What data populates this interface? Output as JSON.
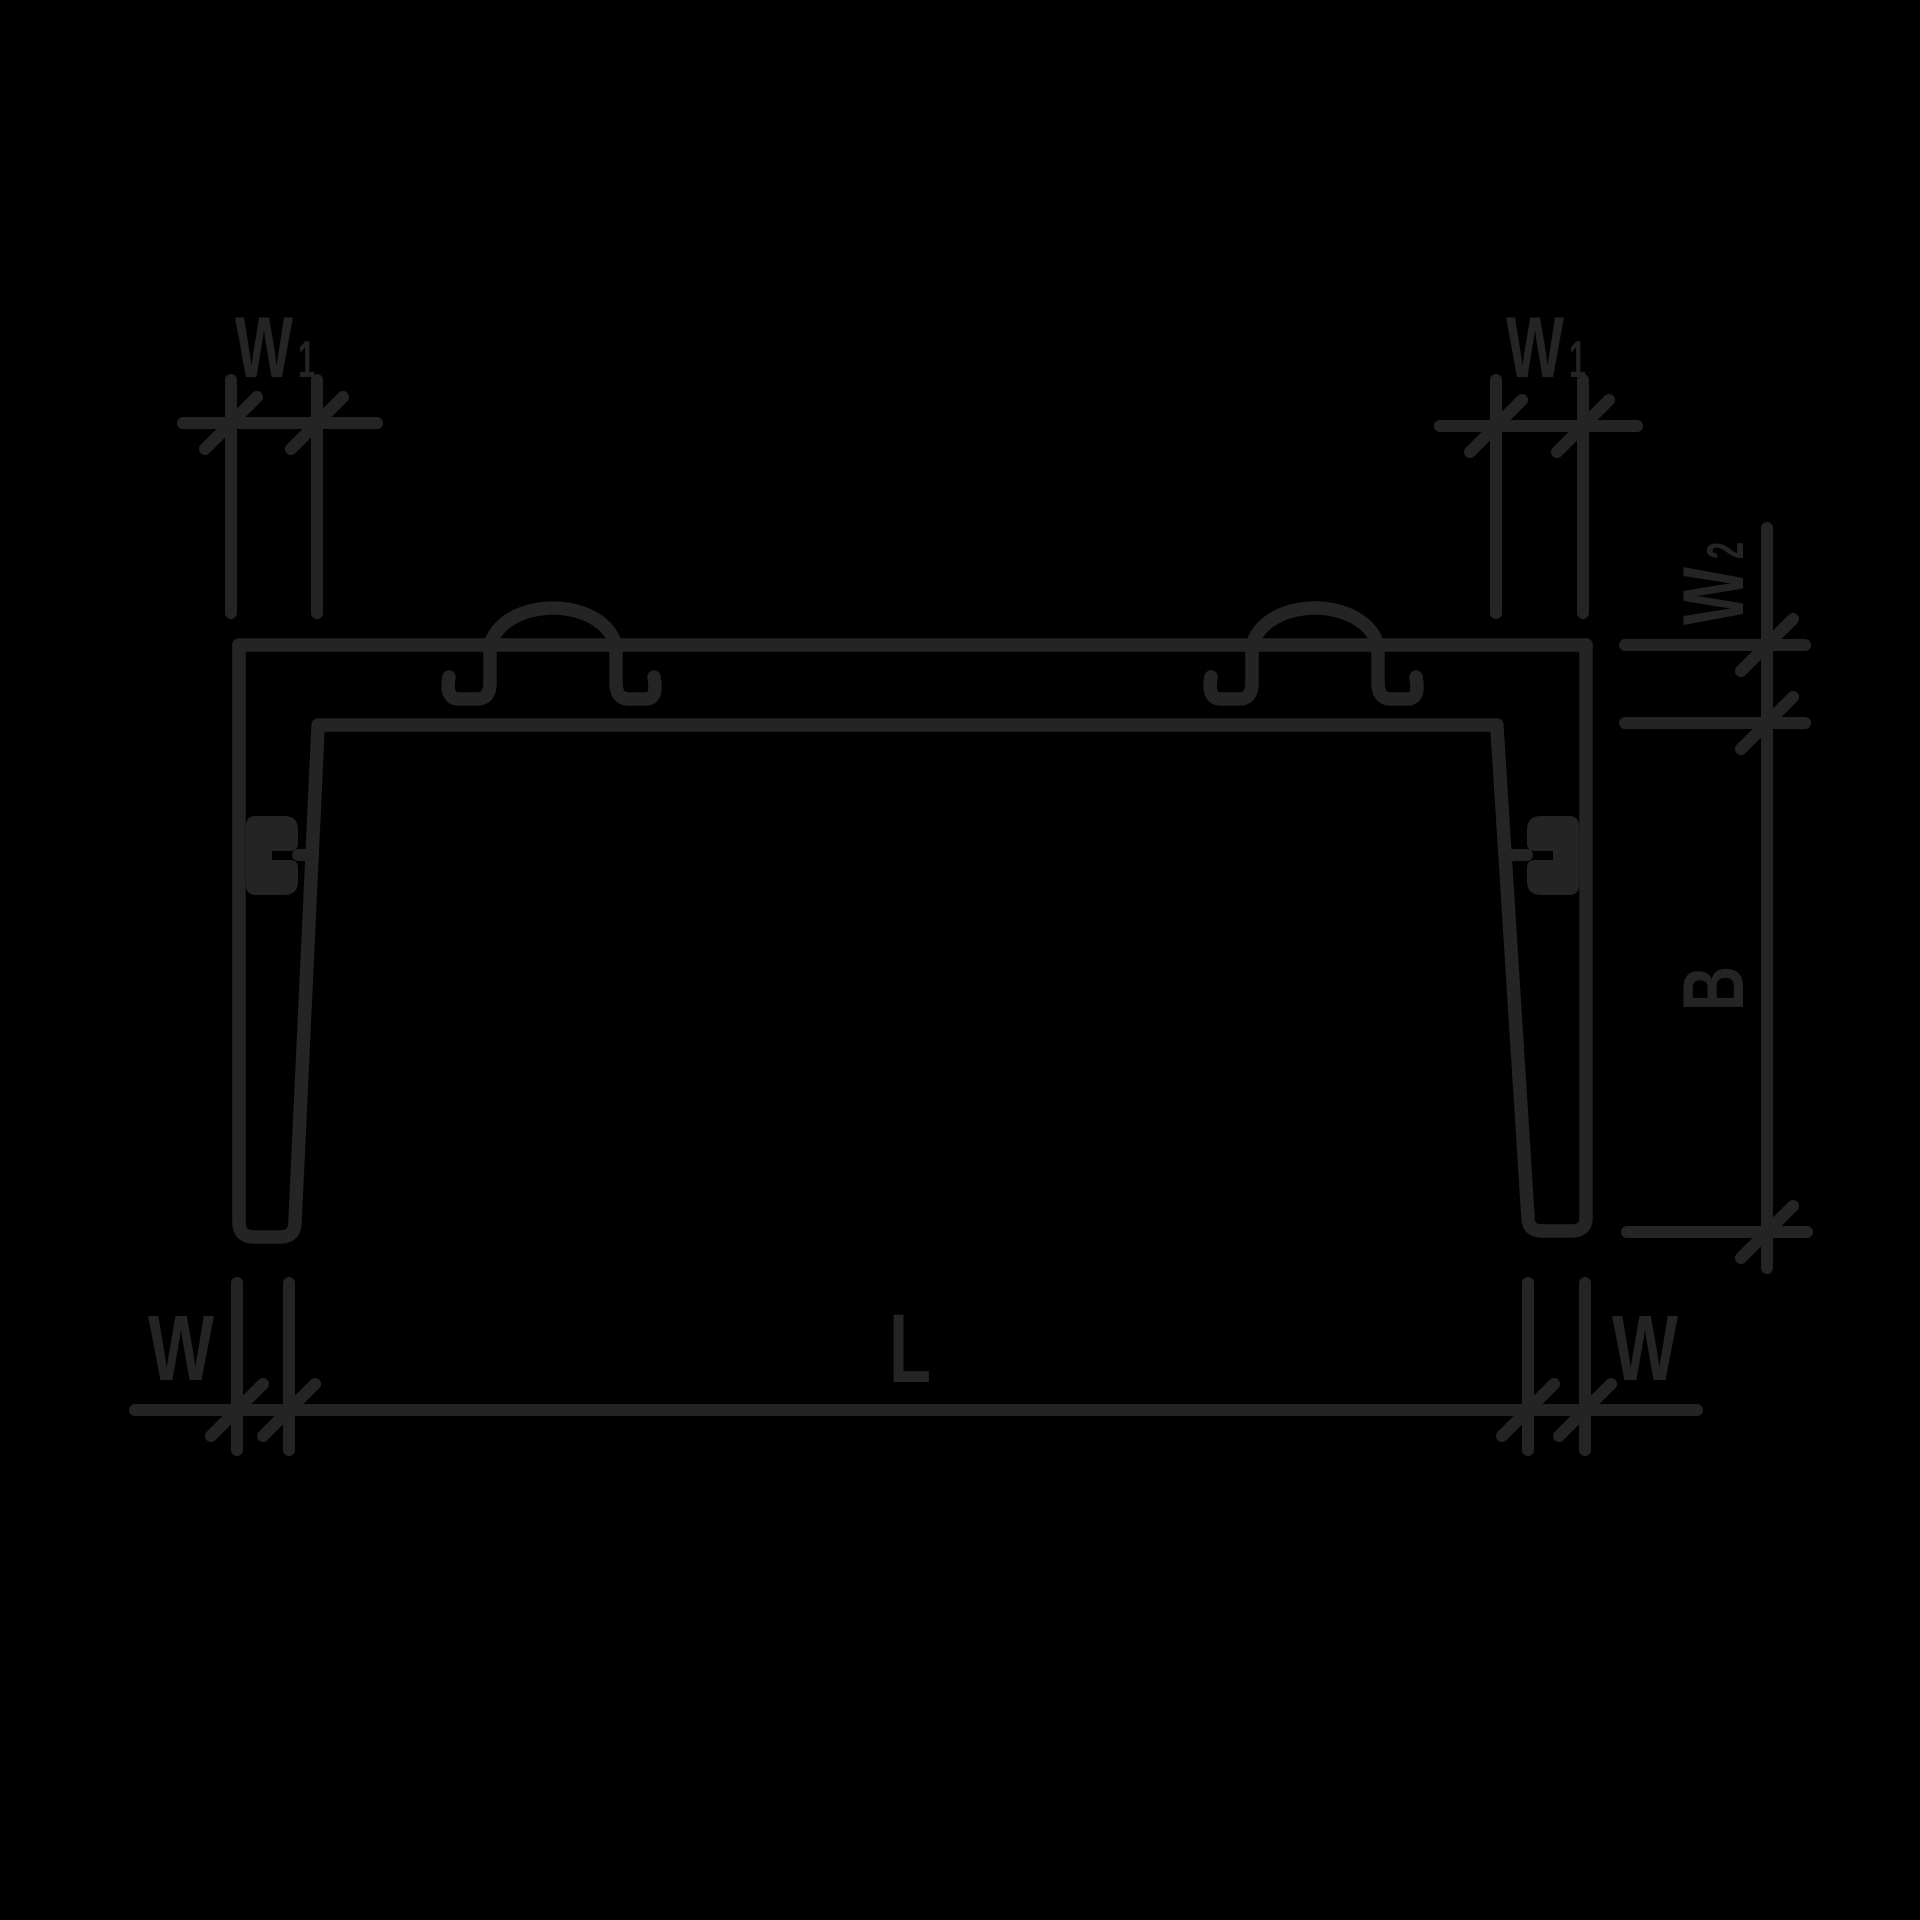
{
  "drawing": {
    "title": "profile-cross-section-dimension-diagram",
    "background_color": "#000000",
    "line_color": "#242424",
    "dimension_style": "oblique-tick"
  },
  "labels": {
    "w1_left": {
      "base": "W",
      "sub": "1"
    },
    "w1_right": {
      "base": "W",
      "sub": "1"
    },
    "w2": {
      "base": "W",
      "sub": "2"
    },
    "b": {
      "base": "B"
    },
    "w_bottom_left": {
      "base": "W"
    },
    "w_bottom_right": {
      "base": "W"
    },
    "length": {
      "base": "L"
    }
  }
}
